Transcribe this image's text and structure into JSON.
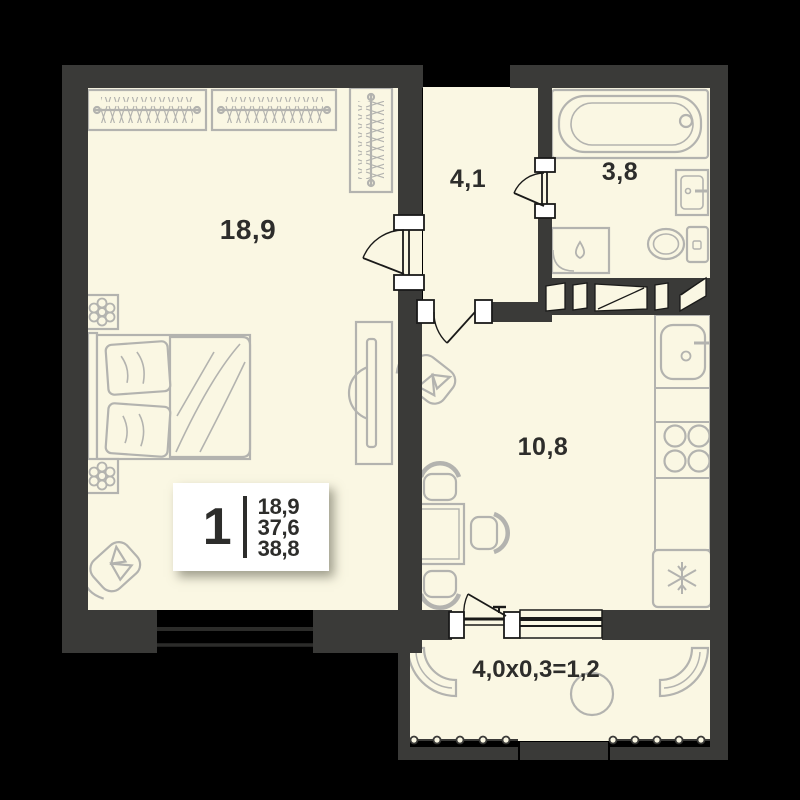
{
  "plan": {
    "rooms": [
      {
        "name": "living-room",
        "area_label": "18,9"
      },
      {
        "name": "hallway",
        "area_label": "4,1"
      },
      {
        "name": "bathroom",
        "area_label": "3,8"
      },
      {
        "name": "kitchen",
        "area_label": "10,8"
      },
      {
        "name": "balcony",
        "area_label": "4,0x0,3=1,2"
      }
    ],
    "legend": {
      "rooms_count": "1",
      "living_area": "18,9",
      "floor_area": "37,6",
      "total_area": "38,8"
    },
    "colors": {
      "background": "#000000",
      "wall": "#3a3a38",
      "floor": "#faf7e3",
      "furniture_line": "#b3b3af",
      "door_line": "#1a1a19",
      "text": "#2d2d2b",
      "legend_bg": "#ffffff"
    }
  }
}
